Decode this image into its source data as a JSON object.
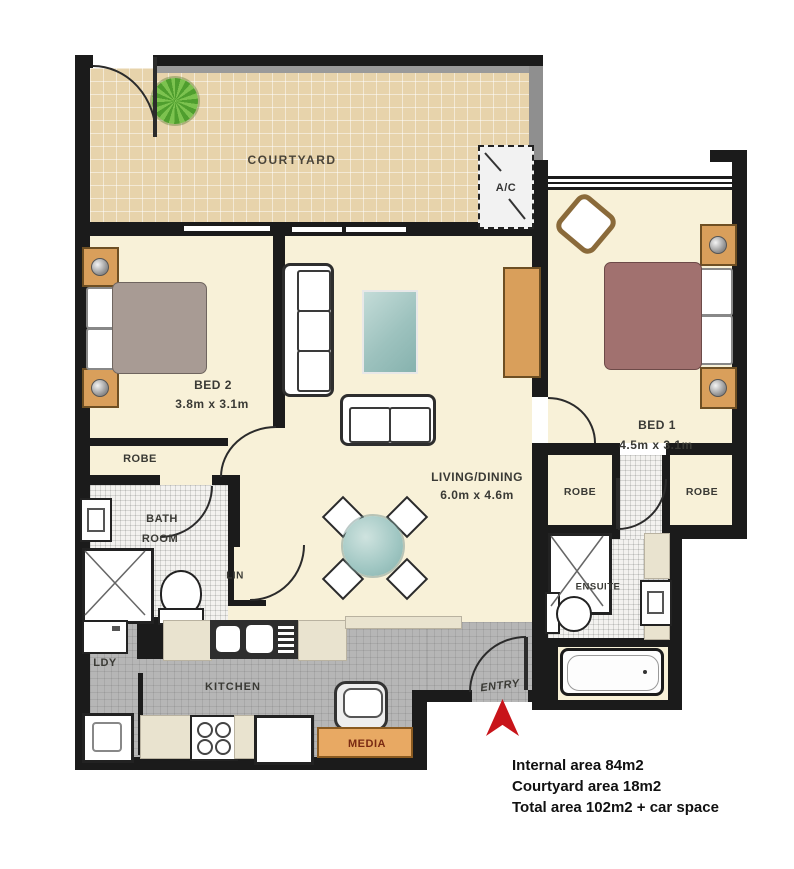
{
  "plan": {
    "title": "Apartment floor plan",
    "rooms": {
      "courtyard": {
        "label": "COURTYARD"
      },
      "ac": {
        "label": "A/C"
      },
      "bed2": {
        "label": "BED 2",
        "dims": "3.8m x 3.1m"
      },
      "bed1": {
        "label": "BED 1",
        "dims": "4.5m x 3.1m"
      },
      "living": {
        "label": "LIVING/DINING",
        "dims": "6.0m x 4.6m"
      },
      "bathroom": {
        "label_line1": "BATH",
        "label_line2": "ROOM"
      },
      "ensuite": {
        "label": "ENSUITE"
      },
      "kitchen": {
        "label": "KITCHEN"
      },
      "laundry": {
        "label": "LDY"
      },
      "linen": {
        "label": "LIN"
      },
      "entry": {
        "label": "ENTRY"
      },
      "media": {
        "label": "MEDIA"
      },
      "robe_bed2": {
        "label": "ROBE"
      },
      "robe_bed1_left": {
        "label": "ROBE"
      },
      "robe_bed1_right": {
        "label": "ROBE"
      }
    },
    "areas": {
      "internal": "Internal area 84m2",
      "courtyard": "Courtyard area 18m2",
      "total": "Total area 102m2 + car space"
    },
    "colors": {
      "wall": "#1b1b1b",
      "interior_floor": "#f8f1d8",
      "courtyard_floor": "#e7d3ab",
      "kitchen_floor": "#b6b6b6",
      "tile_floor": "#f3f2ef",
      "wood": "#d99f5b",
      "media_cabinet": "#e8a963",
      "bed1_cover": "#a1716f",
      "bed2_cover": "#a89b94",
      "rug": "#a9cdc9",
      "entry_arrow": "#c8141a",
      "plant": "#5aa832"
    }
  }
}
